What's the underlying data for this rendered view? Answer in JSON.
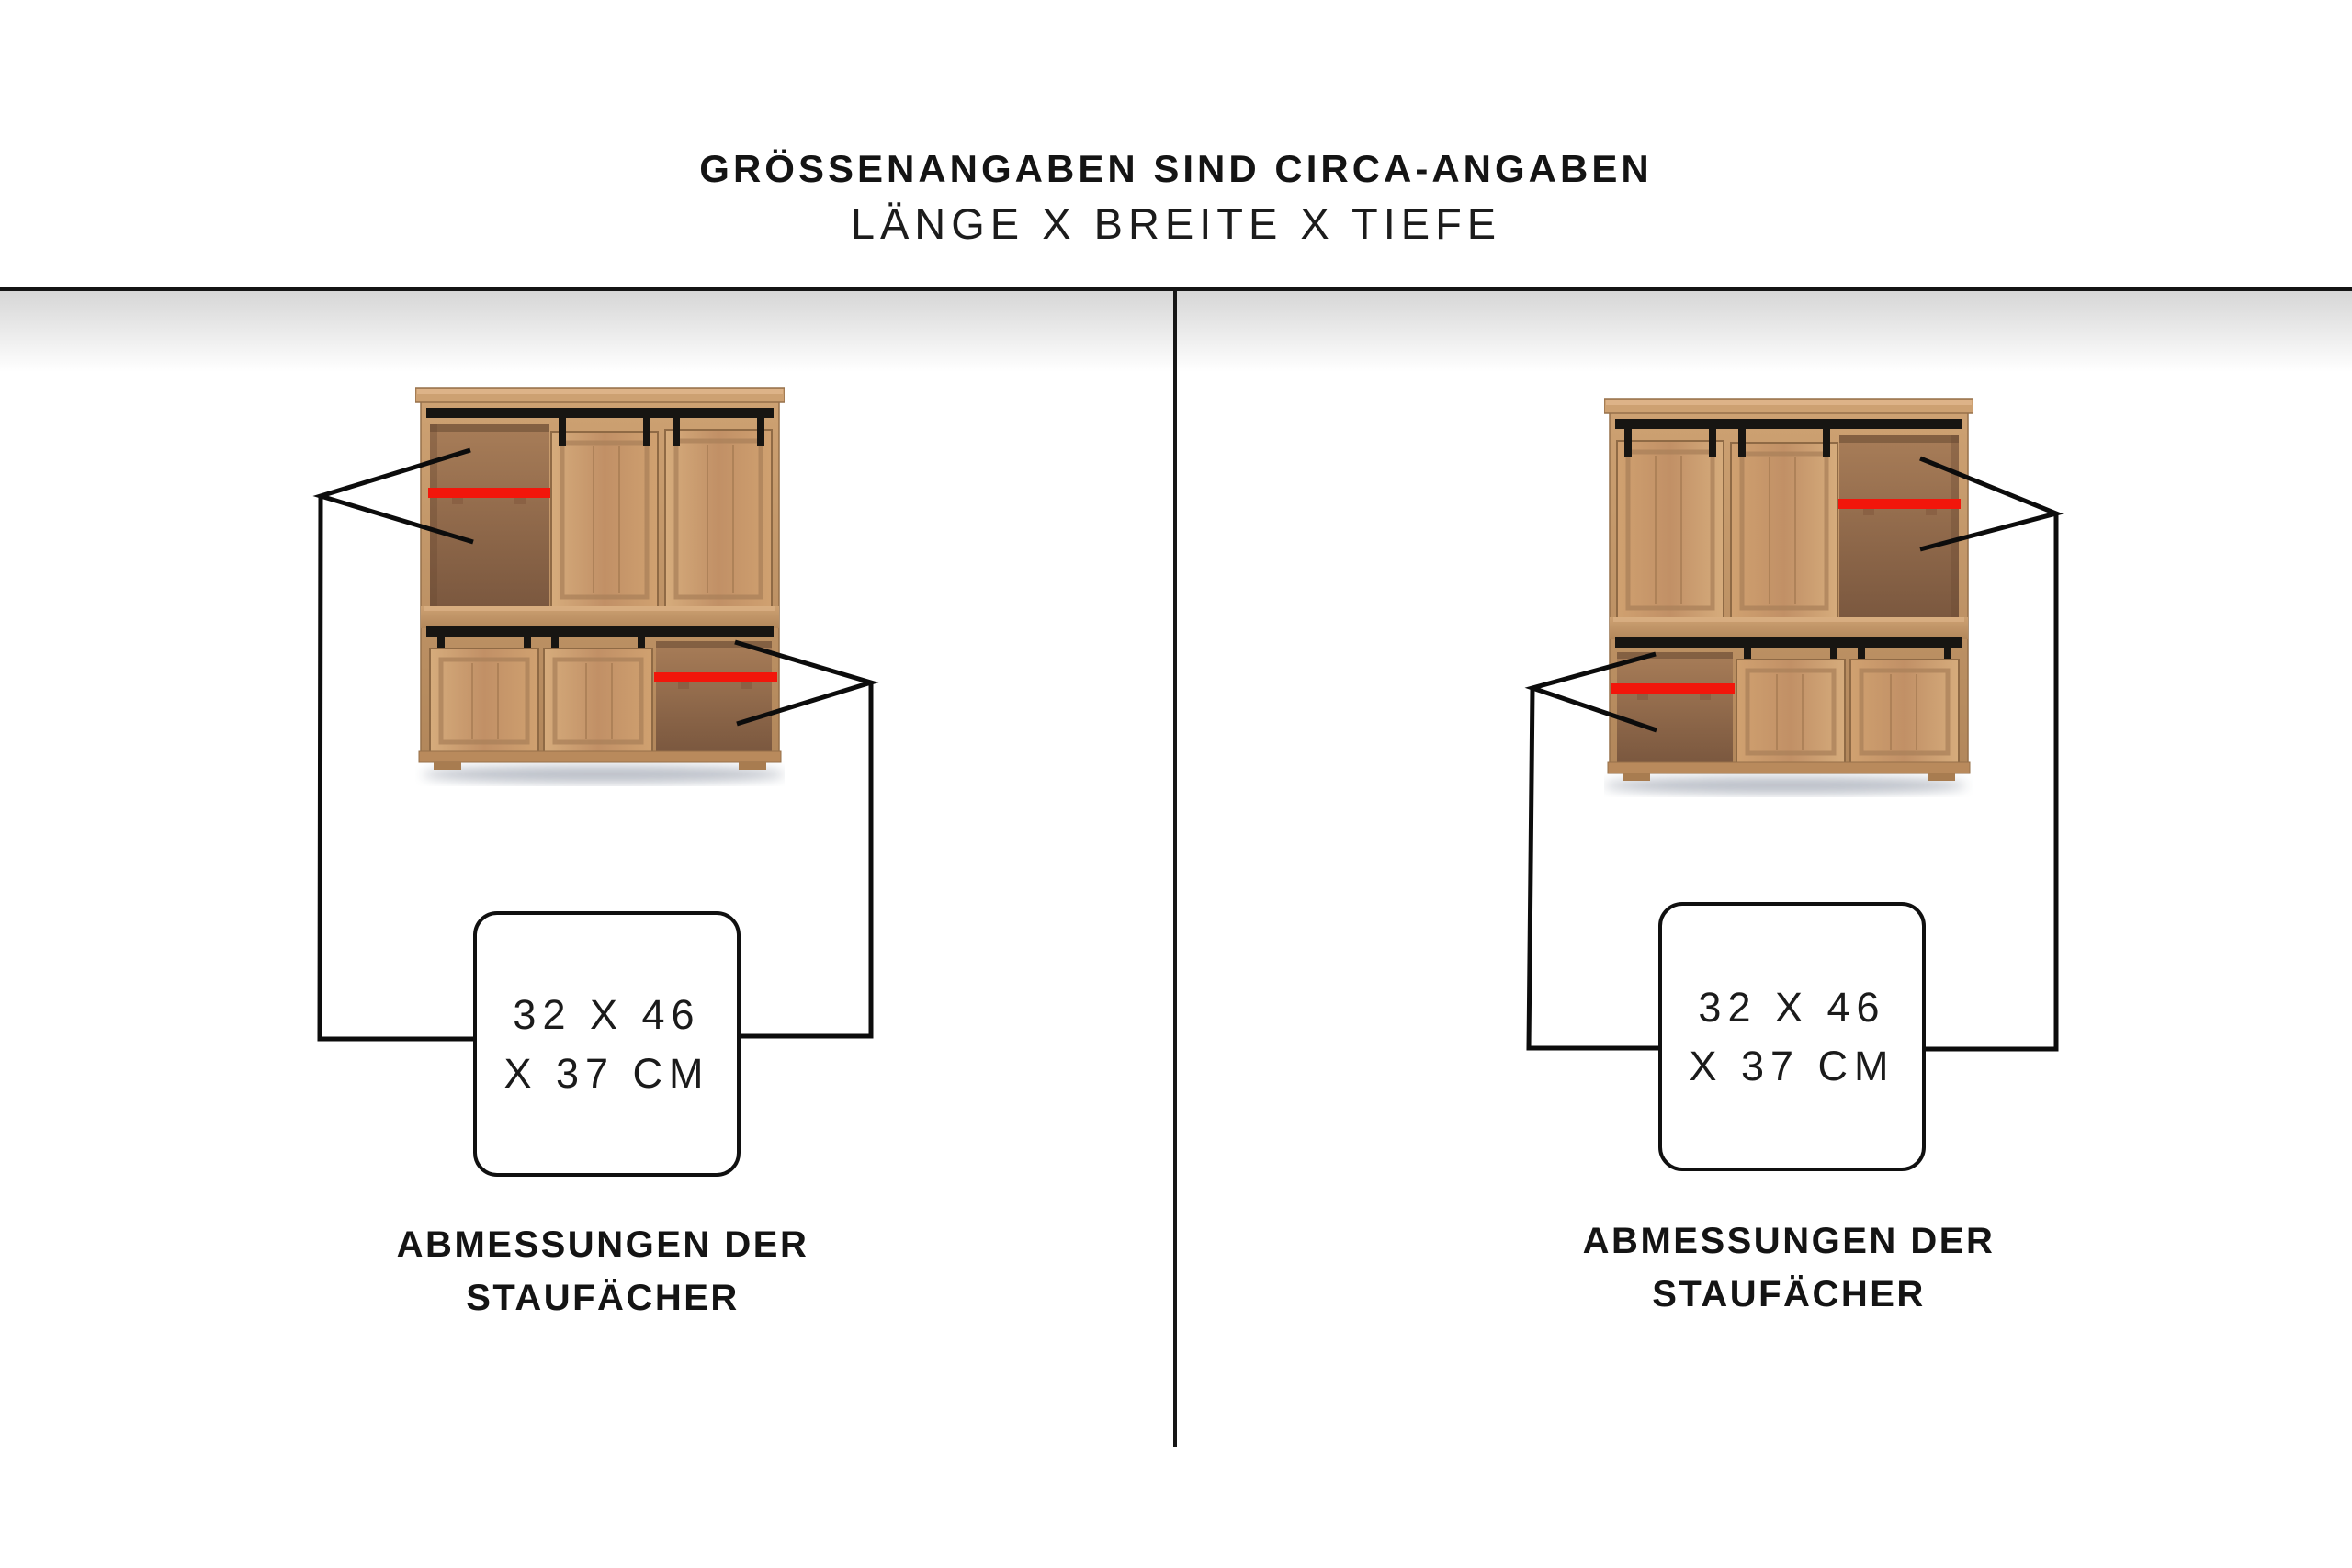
{
  "header": {
    "title": "GRÖSSENANGABEN SIND CIRCA-ANGABEN",
    "subtitle": "LÄNGE X BREITE X TIEFE"
  },
  "panels": [
    {
      "id": "left",
      "dim_line1": "32 X 46",
      "dim_line2": "X 37 CM",
      "caption_line1": "ABMESSUNGEN DER",
      "caption_line2": "STAUFÄCHER"
    },
    {
      "id": "right",
      "dim_line1": "32 X 46",
      "dim_line2": "X 37 CM",
      "caption_line1": "ABMESSUNGEN DER",
      "caption_line2": "STAUFÄCHER"
    }
  ],
  "colors": {
    "shelf_highlight": "#f2160b",
    "annotation_line": "#0c0c0c",
    "divider": "#161616"
  }
}
